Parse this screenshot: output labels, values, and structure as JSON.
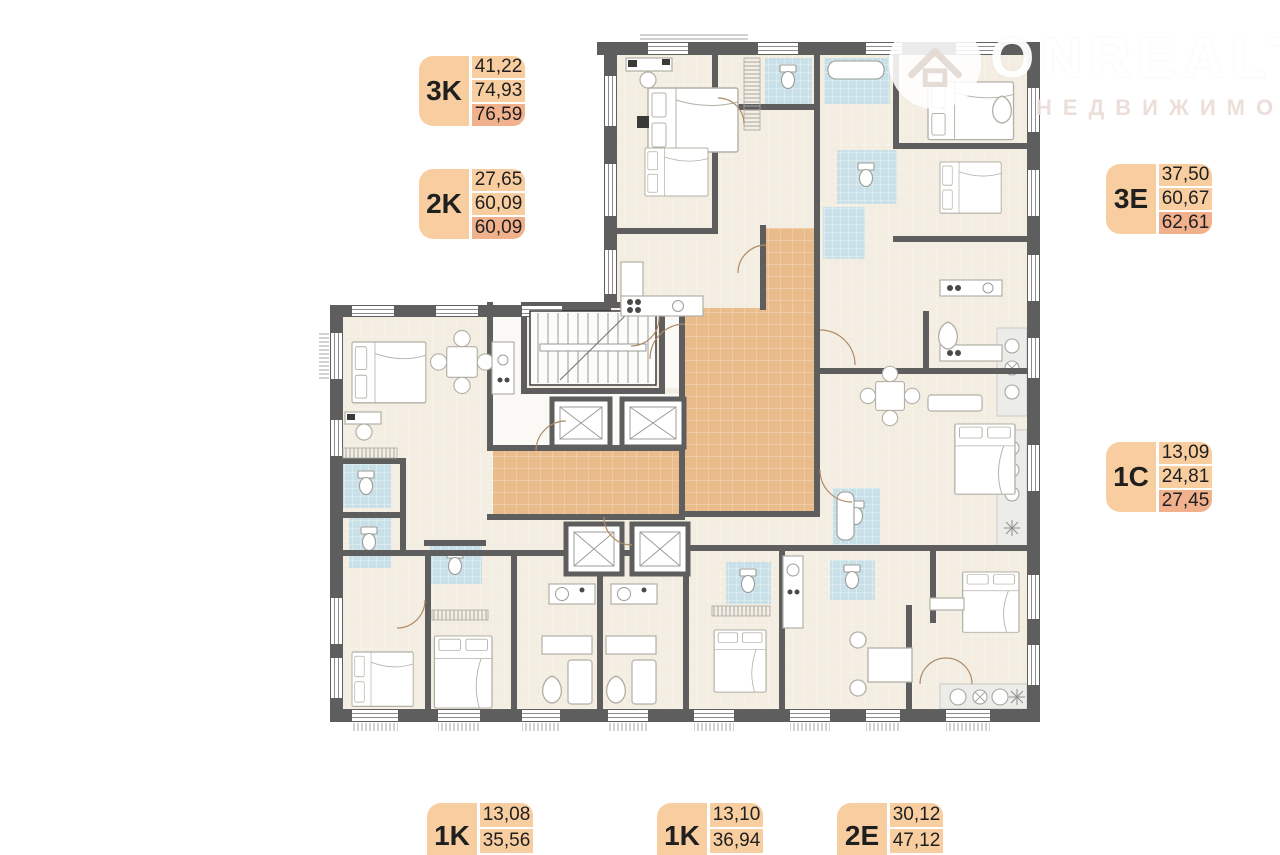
{
  "page": {
    "background": "#FFFFFF",
    "kind": "residential floor plan"
  },
  "watermark": {
    "brand": "ONREALT",
    "subtitle": "НЕДВИЖИМОСТЬ"
  },
  "apartment_tags": [
    {
      "code": "3K",
      "values": [
        "41,22",
        "74,93",
        "76,59"
      ]
    },
    {
      "code": "2K",
      "values": [
        "27,65",
        "60,09",
        "60,09"
      ]
    },
    {
      "code": "3E",
      "values": [
        "37,50",
        "60,67",
        "62,61"
      ]
    },
    {
      "code": "1C",
      "values": [
        "13,09",
        "24,81",
        "27,45"
      ]
    },
    {
      "code": "1K",
      "values": [
        "13,08",
        "35,56"
      ]
    },
    {
      "code": "1K",
      "values": [
        "13,10",
        "36,94"
      ]
    },
    {
      "code": "2E",
      "values": [
        "30,12",
        "47,12"
      ]
    }
  ],
  "palette": {
    "wall": "#5E5E5E",
    "floor": "#F3EDE2",
    "corridor": "#EABB8B",
    "bathroom": "#C9E0E8",
    "loggia": "#ECECE9",
    "tag_bg": "#F8CEA1",
    "tag_highlight": "#F1B18D",
    "tag_text": "#1F1F1F"
  }
}
